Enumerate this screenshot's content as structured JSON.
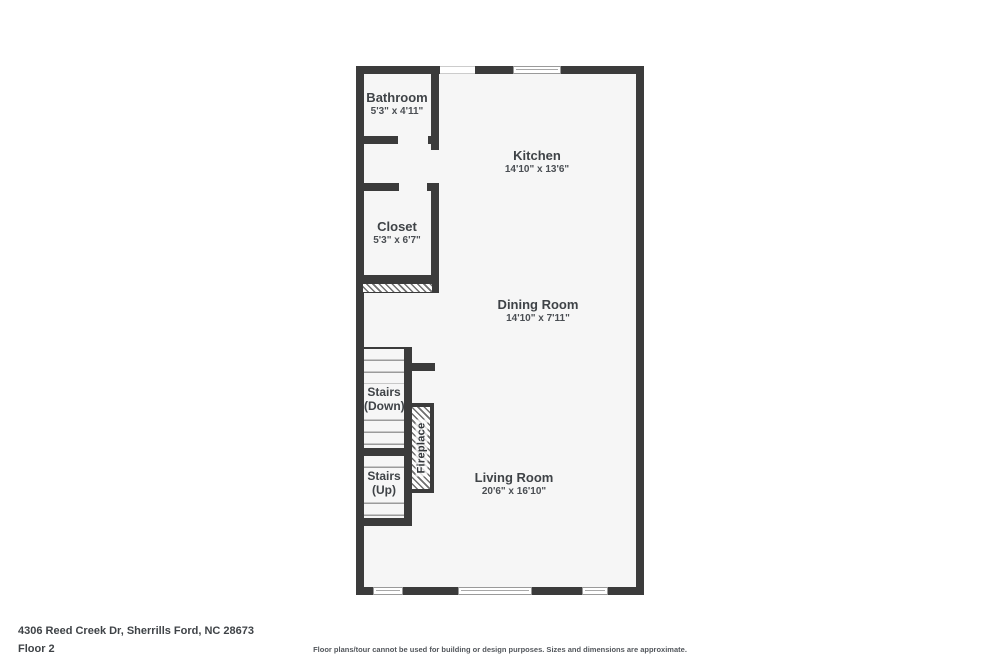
{
  "plan": {
    "rooms": [
      {
        "name": "Bathroom",
        "dims": "5'3\" x 4'11\""
      },
      {
        "name": "Kitchen",
        "dims": "14'10\" x 13'6\""
      },
      {
        "name": "Closet",
        "dims": "5'3\" x 6'7\""
      },
      {
        "name": "Dining Room",
        "dims": "14'10\" x 7'11\""
      },
      {
        "name": "Living Room",
        "dims": "20'6\" x 16'10\""
      }
    ],
    "stairs": [
      {
        "line1": "Stairs",
        "line2": "(Down)"
      },
      {
        "line1": "Stairs",
        "line2": "(Up)"
      }
    ],
    "fireplace_label": "Fireplace"
  },
  "footer": {
    "address": "4306 Reed Creek Dr, Sherrills Ford, NC 28673",
    "floor": "Floor 2",
    "disclaimer": "Floor plans/tour cannot be used for building or design purposes. Sizes and dimensions are approximate."
  },
  "colors": {
    "wall": "#3b3b3b",
    "floor": "#f6f6f6",
    "text": "#3f4347"
  }
}
